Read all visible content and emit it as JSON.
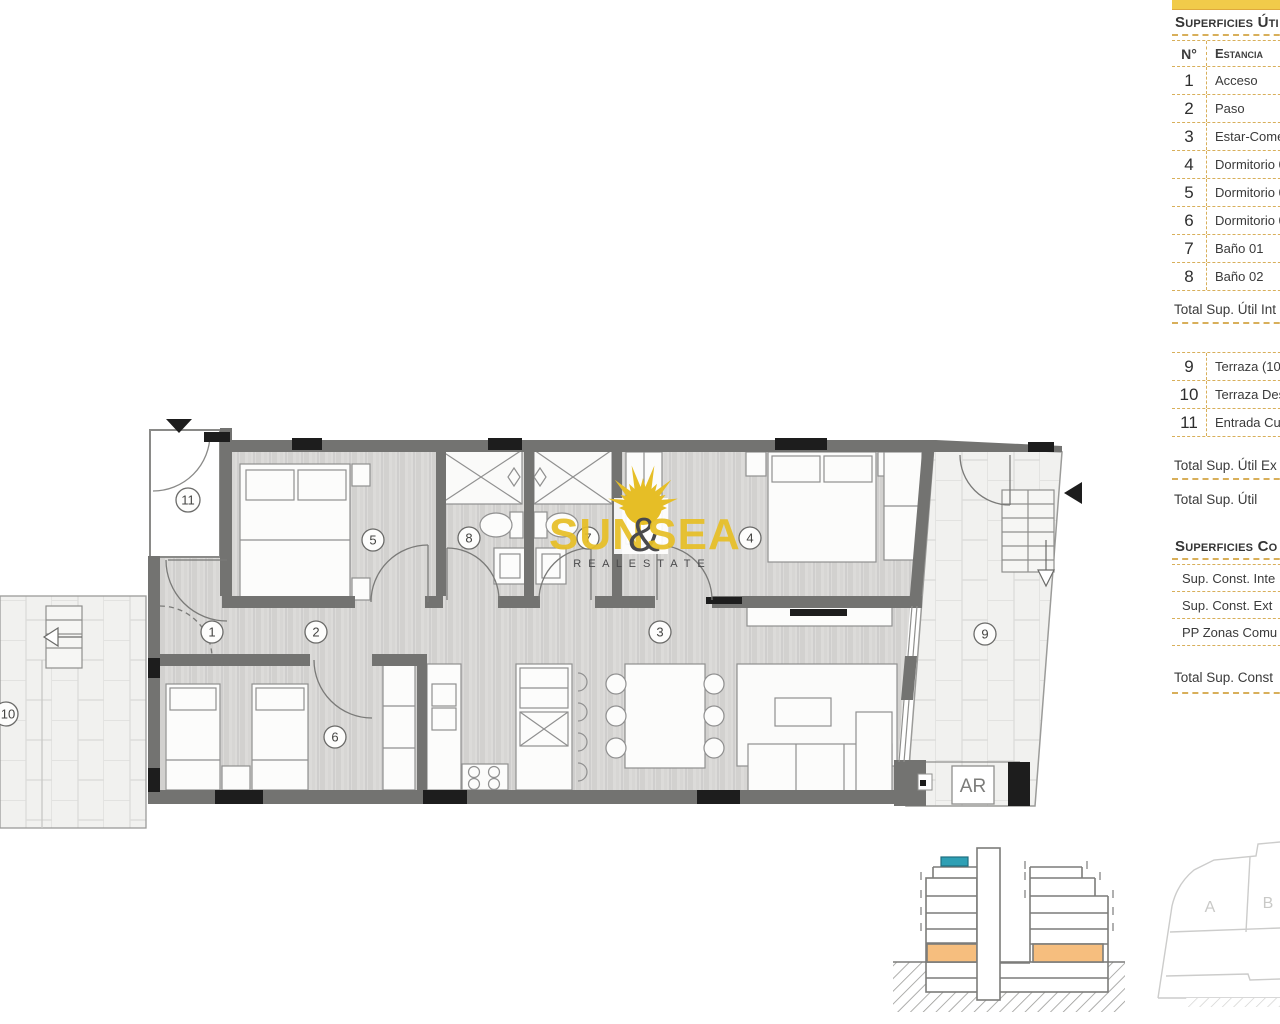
{
  "panel": {
    "accent_bar_color": "#F1CB4A",
    "dash_color": "#D8AF5A",
    "utiles": {
      "title": "Superficies Úti",
      "col_num": "N°",
      "col_name": "Estancia",
      "rows": [
        {
          "num": "1",
          "name": "Acceso"
        },
        {
          "num": "2",
          "name": "Paso"
        },
        {
          "num": "3",
          "name": "Estar-Come"
        },
        {
          "num": "4",
          "name": "Dormitorio 0"
        },
        {
          "num": "5",
          "name": "Dormitorio 0"
        },
        {
          "num": "6",
          "name": "Dormitorio 0"
        },
        {
          "num": "7",
          "name": "Baño 01"
        },
        {
          "num": "8",
          "name": "Baño 02"
        }
      ],
      "total_interior_label": "Total Sup. Útil Int",
      "exterior_rows": [
        {
          "num": "9",
          "name": "Terraza (10"
        },
        {
          "num": "10",
          "name": "Terraza Des"
        },
        {
          "num": "11",
          "name": "Entrada Cub"
        }
      ],
      "total_exterior_label": "Total Sup. Útil Ex",
      "total_label": "Total Sup. Útil"
    },
    "construidas": {
      "title": "Superficies Co",
      "rows": [
        {
          "name": "Sup. Const. Inte"
        },
        {
          "name": "Sup. Const. Ext"
        },
        {
          "name": "PP Zonas Comu"
        }
      ],
      "total_label": "Total Sup. Const"
    }
  },
  "logo": {
    "word_sun": "SUN",
    "ampersand": "&",
    "word_sea": "SEA",
    "subtitle": "R E A L   E S T A T E",
    "gold_color": "#E6BE26",
    "dark_color": "#4A4A4C"
  },
  "plan": {
    "room_labels": {
      "r1": "1",
      "r2": "2",
      "r3": "3",
      "r4": "4",
      "r5": "5",
      "r6": "6",
      "r7": "7",
      "r8": "8",
      "r9": "9",
      "r10": "10",
      "r11": "11"
    },
    "ar_label": "AR"
  },
  "diagrams": {
    "section": {
      "highlight_color": "#F6BE7E",
      "unit_marker_color": "#2E9FB4"
    },
    "site": {
      "label_a": "A",
      "label_b": "B"
    }
  }
}
